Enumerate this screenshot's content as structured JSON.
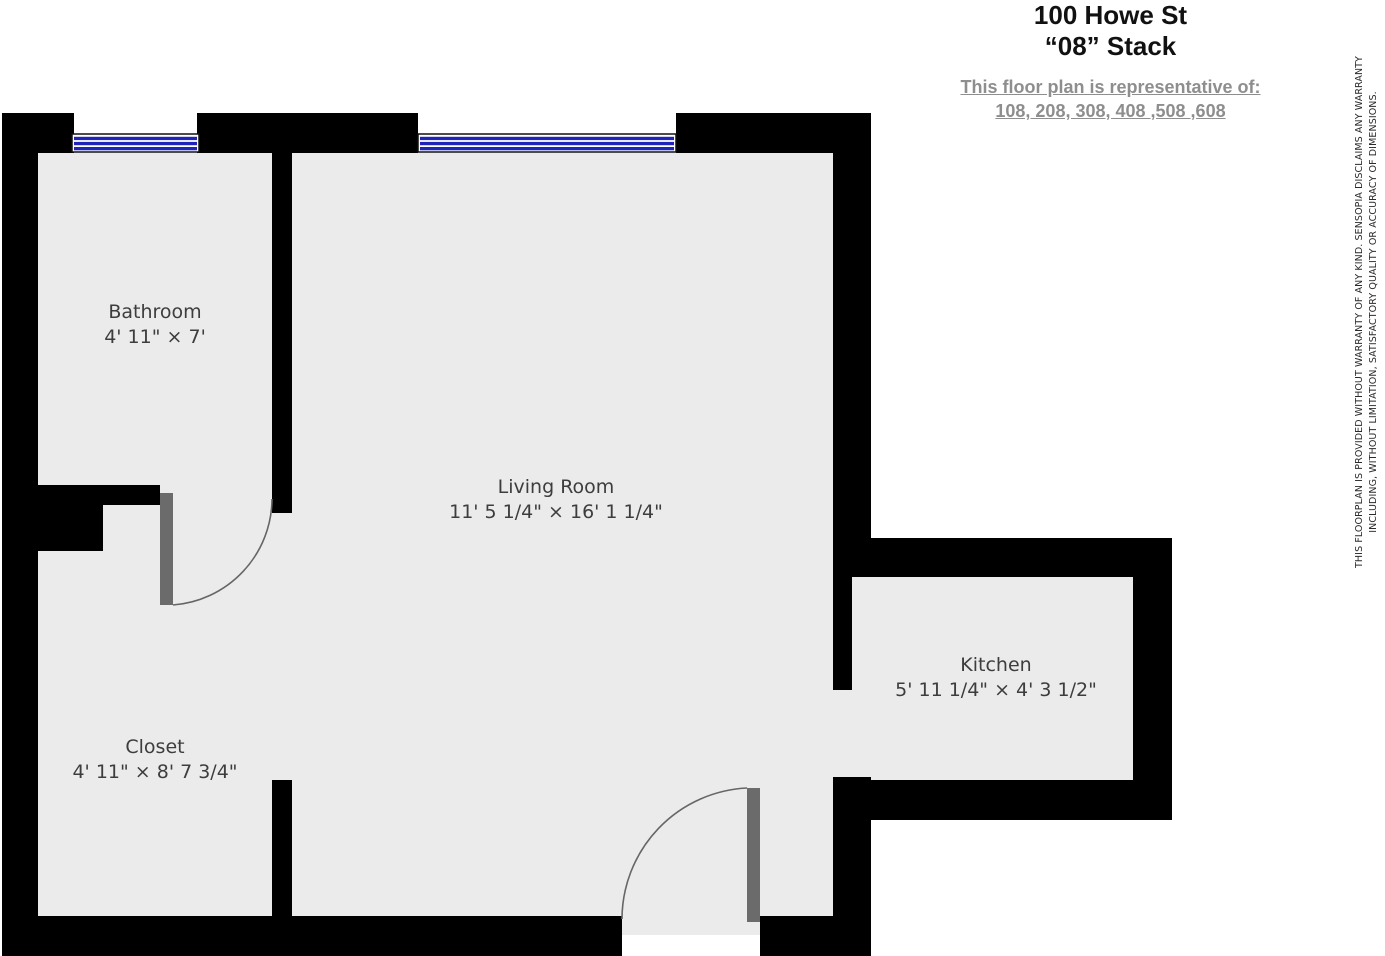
{
  "header": {
    "title_line1": "100 Howe St",
    "title_line2": "“08” Stack",
    "subtitle_line1": "This floor plan is representative of:",
    "subtitle_line2": "108, 208, 308, 408 ,508 ,608"
  },
  "rooms": {
    "bathroom": {
      "name": "Bathroom",
      "dimensions": "4' 11\" × 7'"
    },
    "living_room": {
      "name": "Living Room",
      "dimensions": "11' 5 1/4\" × 16' 1 1/4\""
    },
    "closet": {
      "name": "Closet",
      "dimensions": "4' 11\" × 8' 7 3/4\""
    },
    "kitchen": {
      "name": "Kitchen",
      "dimensions": "5' 11 1/4\" × 4' 3 1/2\""
    }
  },
  "disclaimer": {
    "line1": "THIS FLOORPLAN IS PROVIDED WITHOUT WARRANTY OF ANY KIND. SENSOPIA DISCLAIMS ANY WARRANTY",
    "line2": "INCLUDING, WITHOUT LIMITATION, SATISFACTORY QUALITY OR ACCURACY OF DIMENSIONS."
  },
  "colors": {
    "wall": "#000000",
    "floor": "#ebebeb",
    "window_blue": "#2023b8",
    "window_frame": "#111111",
    "door_slab": "#6b6b6b",
    "door_arc": "#666666",
    "label_text": "#3d3d3d",
    "subtitle_gray": "#8e8e8e"
  }
}
